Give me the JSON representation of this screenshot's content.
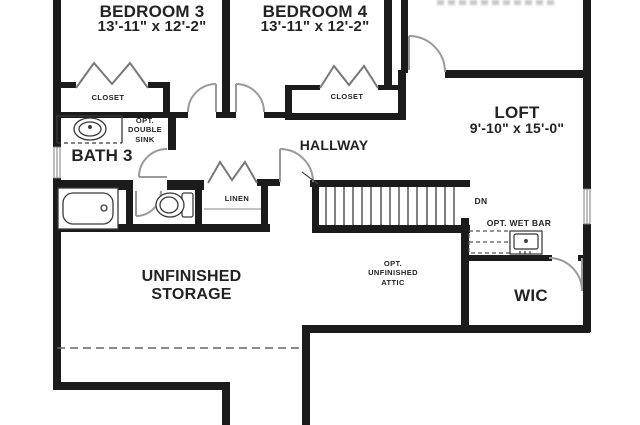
{
  "plan": {
    "rooms": [
      {
        "name": "BEDROOM 3",
        "dims": "13'-11\" x 12'-2\""
      },
      {
        "name": "BEDROOM 4",
        "dims": "13'-11\" x 12'-2\""
      },
      {
        "name": "LOFT",
        "dims": "9'-10\" x 15'-0\""
      },
      {
        "name": "BATH 3"
      },
      {
        "name": "HALLWAY"
      },
      {
        "name": "UNFINISHED STORAGE"
      },
      {
        "name": "OPT. UNFINISHED ATTIC"
      },
      {
        "name": "WIC"
      }
    ],
    "labels": {
      "closet_bed3": "CLOSET",
      "closet_bed4": "CLOSET",
      "opt_double_sink": "OPT. DOUBLE SINK",
      "linen": "LINEN",
      "dn": "DN",
      "opt_wet_bar": "OPT. WET BAR"
    },
    "colors": {
      "wall": "#1b1b1b",
      "thin_line": "#555555",
      "door": "#9a9a9a",
      "text": "#232323",
      "background": "#ffffff"
    }
  }
}
